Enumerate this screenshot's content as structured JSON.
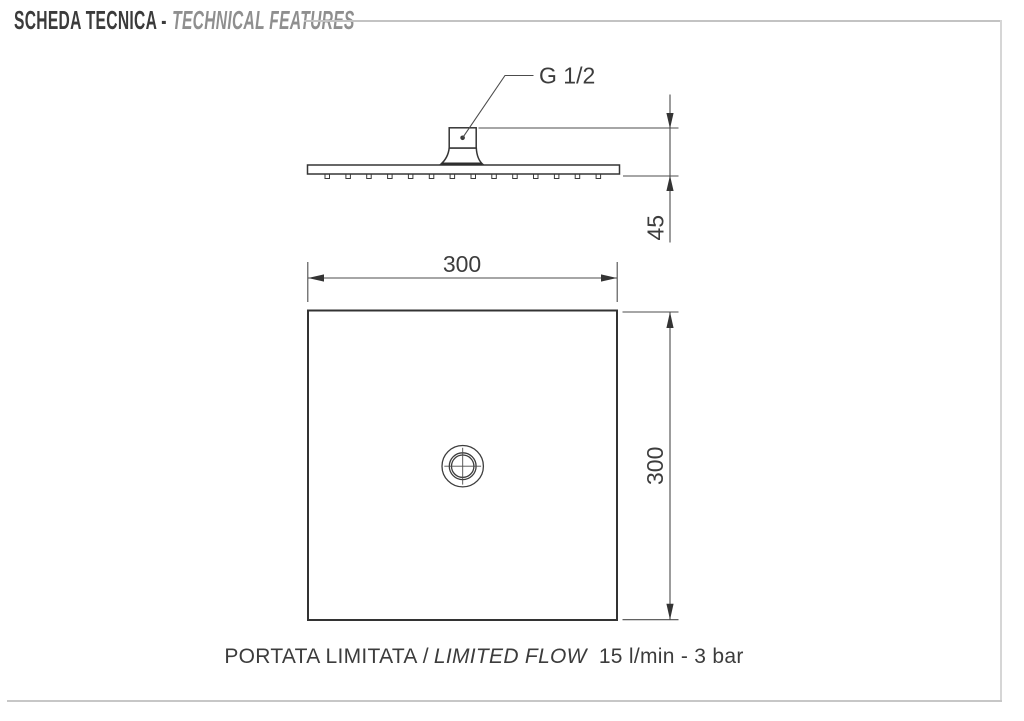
{
  "header": {
    "title_primary": "SCHEDA TECNICA -",
    "title_secondary": "TECHNICAL FEATURES"
  },
  "drawing": {
    "connection_label": "G 1/2",
    "dim_profile_height": "45",
    "dim_width": "300",
    "dim_height": "300"
  },
  "caption": {
    "label_it": "PORTATA LIMITATA /",
    "label_en": "LIMITED FLOW",
    "specs": "15 l/min - 3 bar"
  },
  "colors": {
    "drawing_line": "#3d3d3d",
    "title_primary": "#3b3b3b",
    "title_secondary": "#8f8f8f",
    "rule": "#c3c3c3"
  }
}
